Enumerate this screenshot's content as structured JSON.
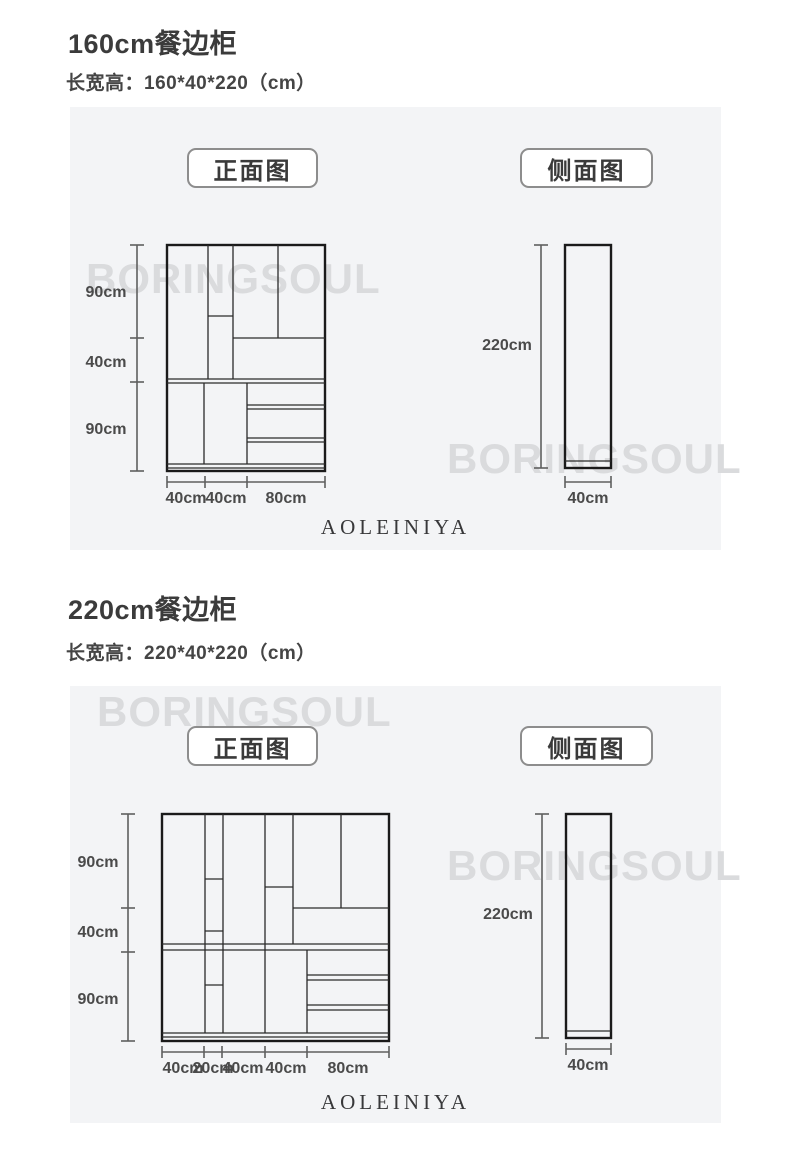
{
  "colors": {
    "panel_bg": "#f3f4f6",
    "watermark": "#dadbdd",
    "line": "#1a1a1a",
    "dim_line": "#5f5f5f"
  },
  "watermark_text": "BORINGSOUL",
  "brand_text": "AOLEINIYA",
  "sections": [
    {
      "title": "160cm餐边柜",
      "subtitle": "长宽高：160*40*220（cm）",
      "front_button": "正面图",
      "side_button": "侧面图",
      "front_view": {
        "name": "front elevation 160cm cabinet",
        "heights": [
          "90cm",
          "40cm",
          "90cm"
        ],
        "widths": [
          "40cm",
          "40cm",
          "80cm"
        ]
      },
      "side_view": {
        "name": "side elevation 160cm cabinet",
        "height": "220cm",
        "width": "40cm"
      }
    },
    {
      "title": "220cm餐边柜",
      "subtitle": "长宽高：220*40*220（cm）",
      "front_button": "正面图",
      "side_button": "侧面图",
      "front_view": {
        "name": "front elevation 220cm cabinet",
        "heights": [
          "90cm",
          "40cm",
          "90cm"
        ],
        "widths": [
          "40cm",
          "20cm",
          "40cm",
          "40cm",
          "80cm"
        ]
      },
      "side_view": {
        "name": "side elevation 220cm cabinet",
        "height": "220cm",
        "width": "40cm"
      }
    }
  ]
}
